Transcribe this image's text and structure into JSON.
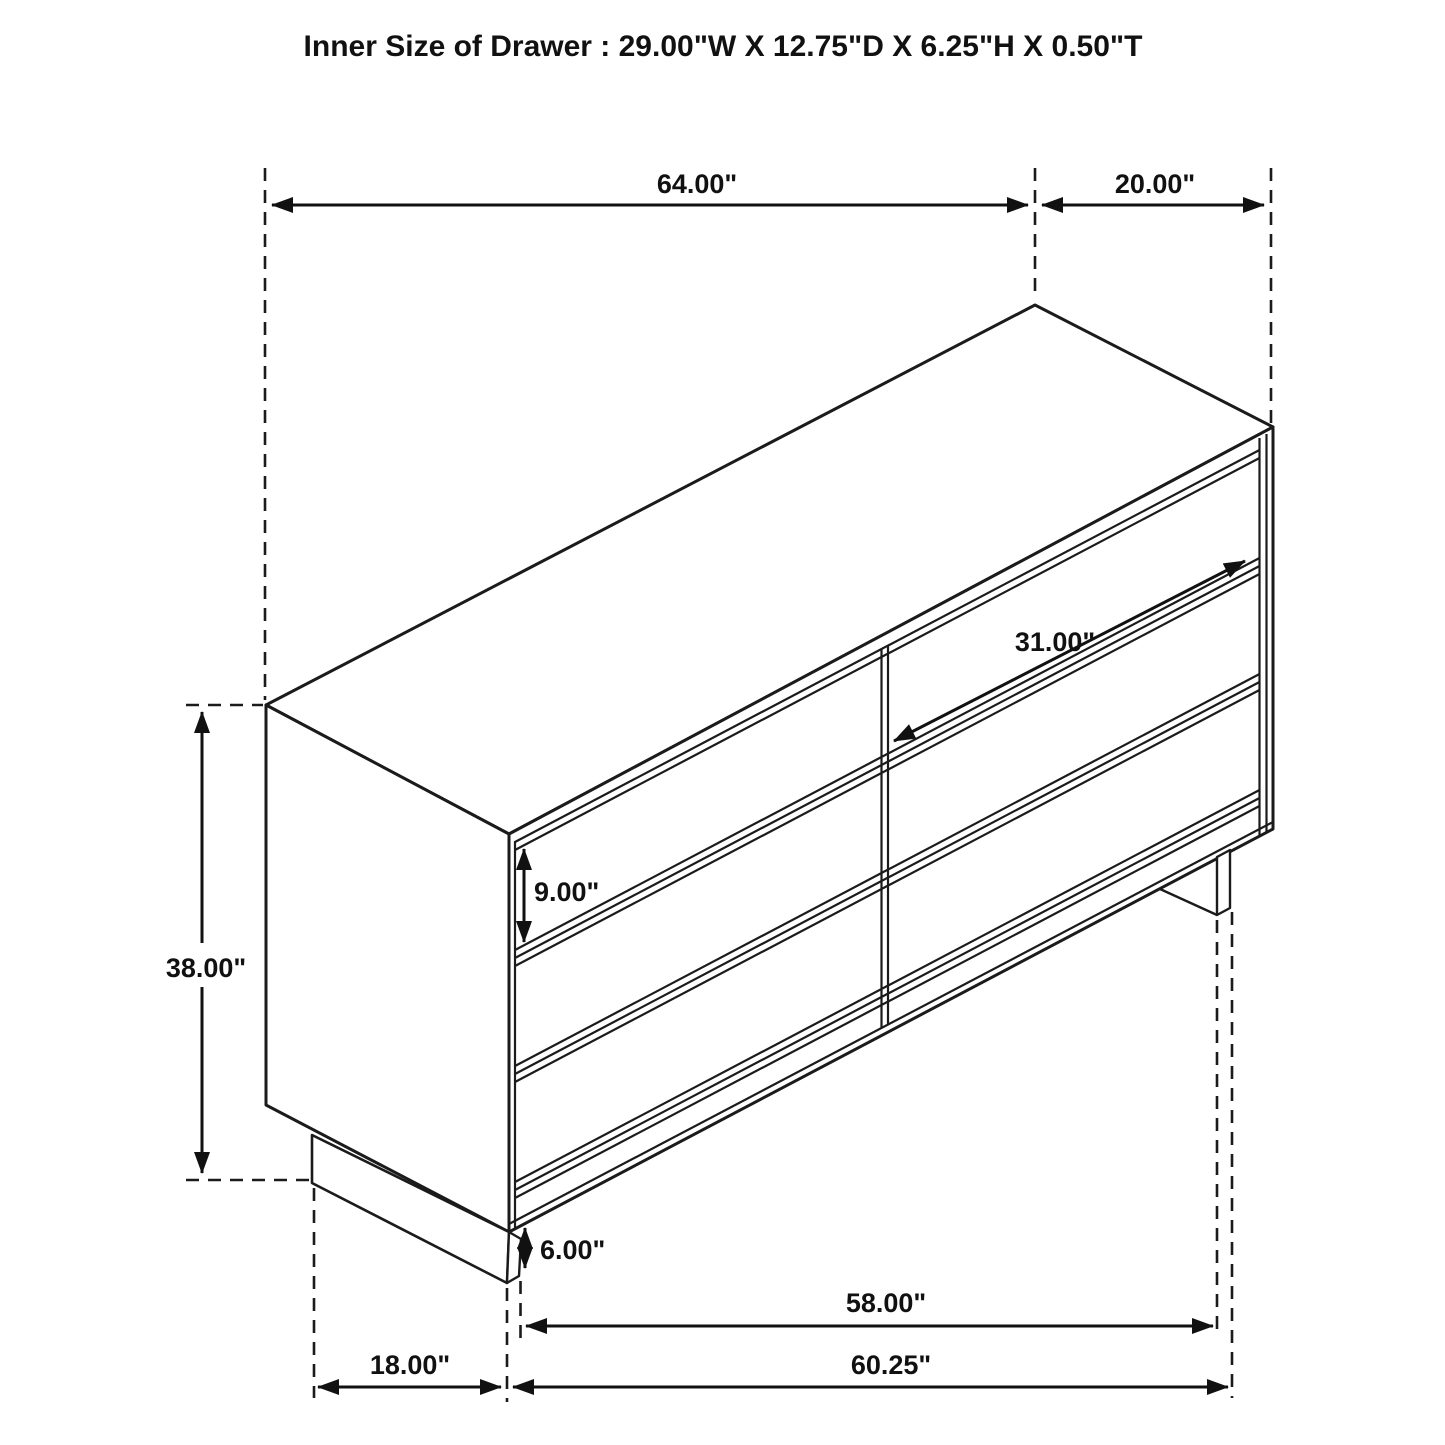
{
  "title": "Inner Size of Drawer : 29.00\"W X 12.75\"D X 6.25\"H X 0.50\"T",
  "dimensions": {
    "overall_width": "64.00\"",
    "overall_depth": "20.00\"",
    "overall_height": "38.00\"",
    "drawer_front_height": "9.00\"",
    "drawer_front_width": "31.00\"",
    "base_height": "6.00\"",
    "base_clearance_width": "58.00\"",
    "base_outer_width": "60.25\"",
    "base_depth": "18.00\""
  },
  "style": {
    "line_color": "#1b1b1b",
    "background": "#ffffff"
  },
  "structure": {
    "drawer_count": "6"
  }
}
